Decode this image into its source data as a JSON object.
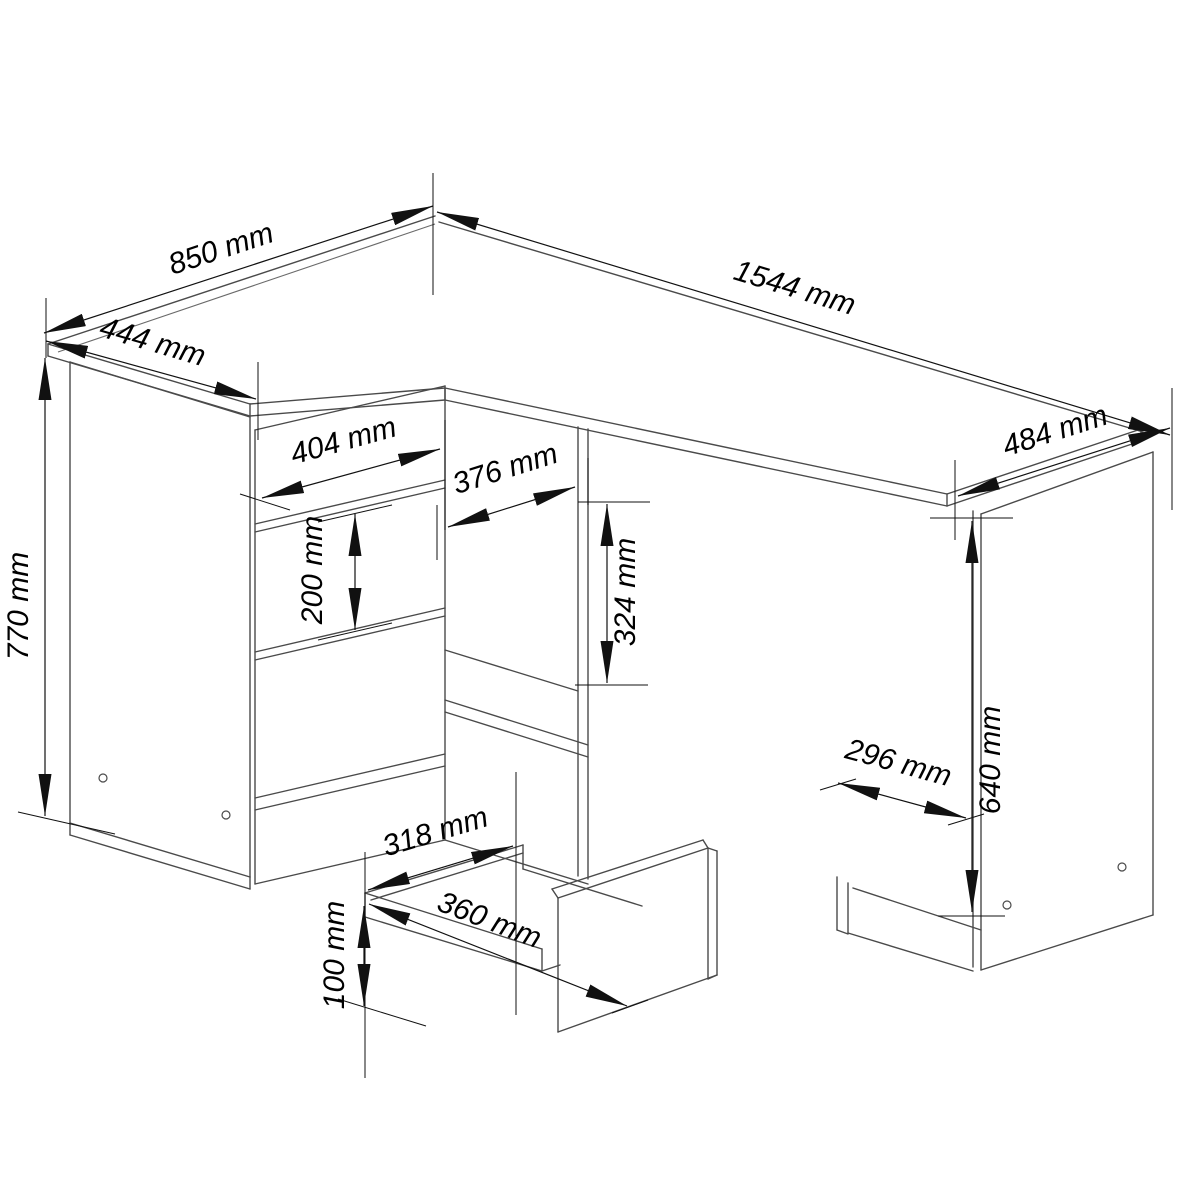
{
  "drawing": {
    "unit": "mm",
    "background_color": "#ffffff",
    "structure_line_color": "#4a4a4a",
    "dimension_line_color": "#111111",
    "labels": {
      "desk_return_depth": "850 mm",
      "desk_return_width": "444 mm",
      "desk_main_length": "1544 mm",
      "desk_right_depth": "484 mm",
      "desk_total_height": "770 mm",
      "drawer_front_width": "404 mm",
      "middle_drawer_front_height": "200 mm",
      "knee_niche_width": "376 mm",
      "knee_niche_height": "324 mm",
      "right_cabinet_door_width": "296 mm",
      "right_cabinet_height": "640 mm",
      "drawer_box_inner_width": "318 mm",
      "drawer_box_outer_width": "360 mm",
      "drawer_box_side_height": "100 mm"
    }
  }
}
